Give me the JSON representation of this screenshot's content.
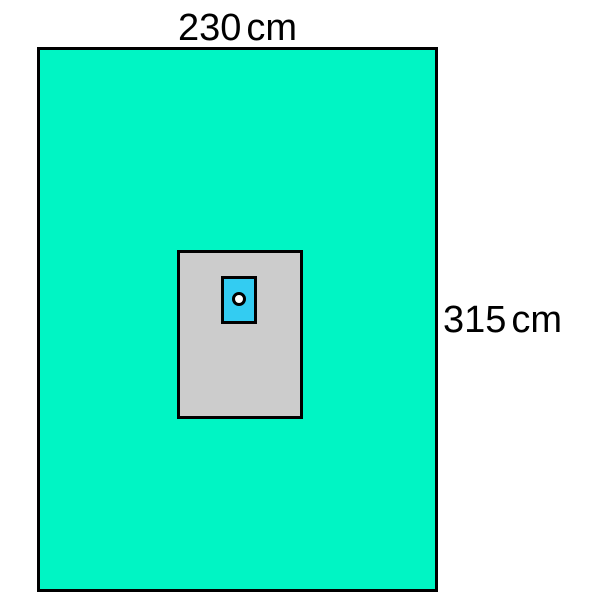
{
  "labels": {
    "width": {
      "value": "230",
      "unit": "cm"
    },
    "height": {
      "value": "315",
      "unit": "cm"
    }
  },
  "colors": {
    "background": "#FFFFFF",
    "outline": "#000000",
    "label_text": "#000000",
    "outer_sheet_fill": "#00F5C4",
    "center_panel_fill": "#CCCCCC",
    "aperture_patch_fill": "#33CCF2",
    "hole_fill": "#FFFFFF"
  }
}
